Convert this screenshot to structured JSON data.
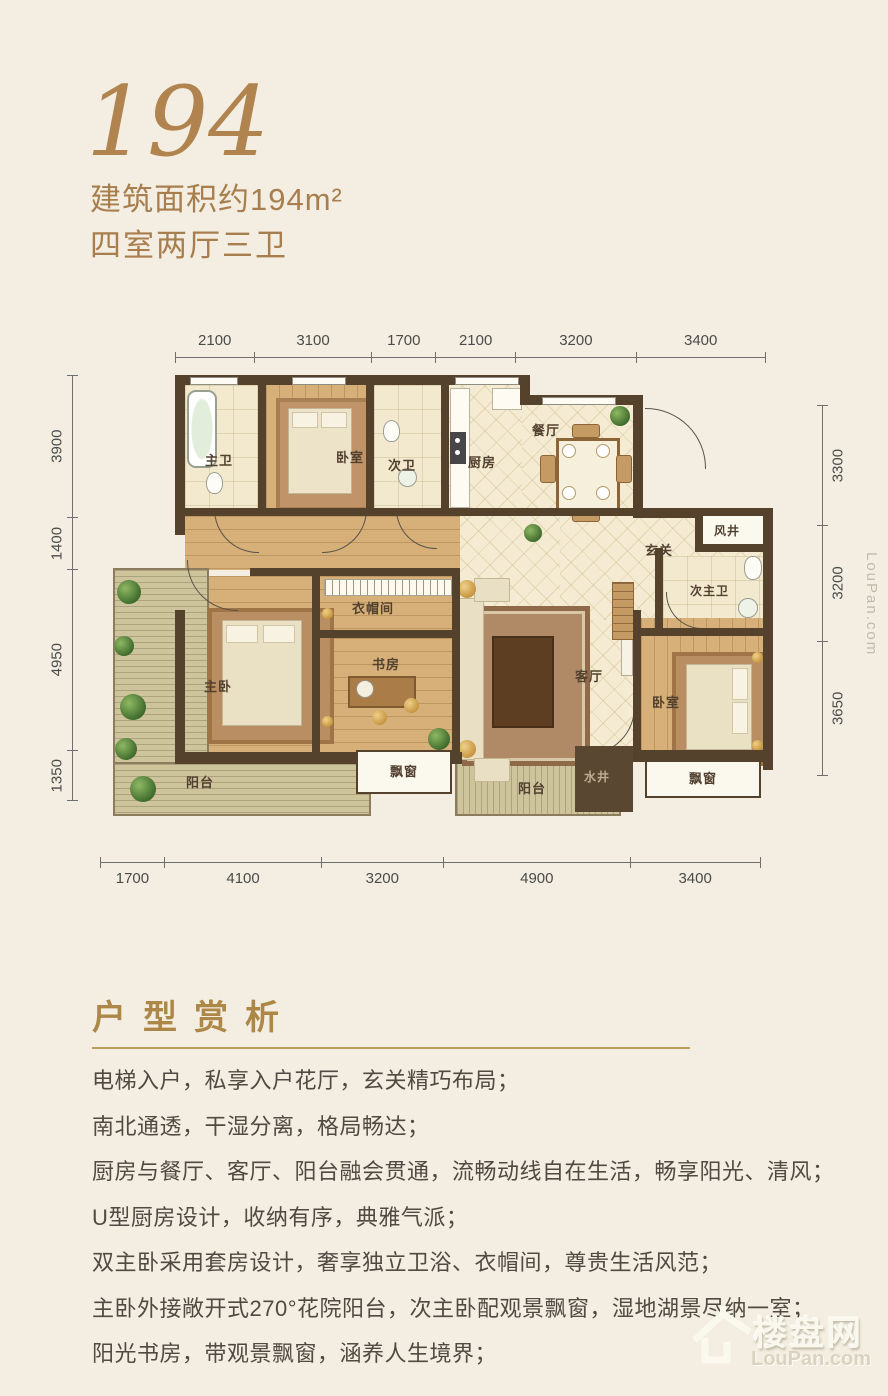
{
  "header": {
    "unit_number": "194",
    "area_text": "建筑面积约194m²",
    "layout_text": "四室两厅三卫"
  },
  "plan": {
    "dims_top": [
      "2100",
      "3100",
      "1700",
      "2100",
      "3200",
      "3400"
    ],
    "dims_bottom": [
      "1700",
      "4100",
      "3200",
      "4900",
      "3400"
    ],
    "dims_left": [
      "3900",
      "1400",
      "4950",
      "1350"
    ],
    "dims_right": [
      "3300",
      "3200",
      "3650"
    ],
    "rooms": {
      "master_bath": "主卫",
      "bedroom_top": "卧室",
      "second_bath": "次卫",
      "kitchen": "厨房",
      "dining": "餐厅",
      "entry": "玄关",
      "air_shaft": "风井",
      "second_master_bath": "次主卫",
      "cloakroom": "衣帽间",
      "master_bedroom": "主卧",
      "study": "书房",
      "living": "客厅",
      "bedroom_right": "卧室",
      "balcony_left": "阳台",
      "balcony_bottom": "阳台",
      "bay_window_left": "飘窗",
      "bay_window_right": "飘窗",
      "water_shaft": "水井"
    }
  },
  "analysis": {
    "title": "户型赏析",
    "features": [
      "电梯入户，私享入户花厅，玄关精巧布局；",
      "南北通透，干湿分离，格局畅达；",
      "厨房与餐厅、客厅、阳台融会贯通，流畅动线自在生活，畅享阳光、清风；",
      "U型厨房设计，收纳有序，典雅气派；",
      "双主卧采用套房设计，奢享独立卫浴、衣帽间，尊贵生活风范；",
      "主卧外接敞开式270°花院阳台，次主卧配观景飘窗，湿地湖景尽纳一室；",
      "阳光书房，带观景飘窗，涵养人生境界；"
    ]
  },
  "watermark": {
    "brand": "楼盘网",
    "domain": "LouPan.com",
    "side": "LouPan.com"
  },
  "colors": {
    "accent": "#ab7e4c",
    "heading": "#ad8747",
    "body_text": "#4f4b42",
    "wall": "#55422c",
    "background": "#f3eee1"
  }
}
